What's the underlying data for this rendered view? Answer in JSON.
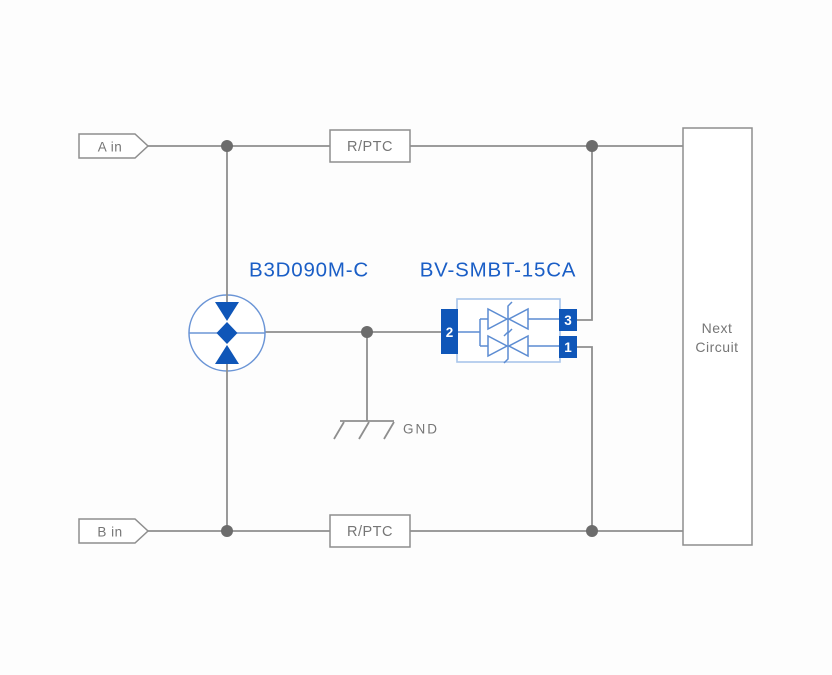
{
  "diagram": {
    "type": "circuit-protection-schematic",
    "inputs": {
      "a": "A in",
      "b": "B in"
    },
    "resistors": {
      "top": "R/PTC",
      "bottom": "R/PTC"
    },
    "gdt": {
      "part_number": "B3D090M-C"
    },
    "tvs": {
      "part_number": "BV-SMBT-15CA",
      "pins": {
        "left": "2",
        "top_right": "3",
        "bottom_right": "1"
      }
    },
    "ground": {
      "label": "GND"
    },
    "next_circuit": {
      "line1": "Next",
      "line2": "Circuit"
    },
    "colors": {
      "wire_gray": "#8e8e8e",
      "junction_gray": "#6c6c6c",
      "text_gray": "#767676",
      "part_label_blue": "#1a5ec6",
      "symbol_fill_blue": "#0f56b8",
      "symbol_stroke_blue": "#5c8cd2",
      "tvs_box_light_blue": "#a8c5ea",
      "background": "#fdfdfd"
    }
  }
}
